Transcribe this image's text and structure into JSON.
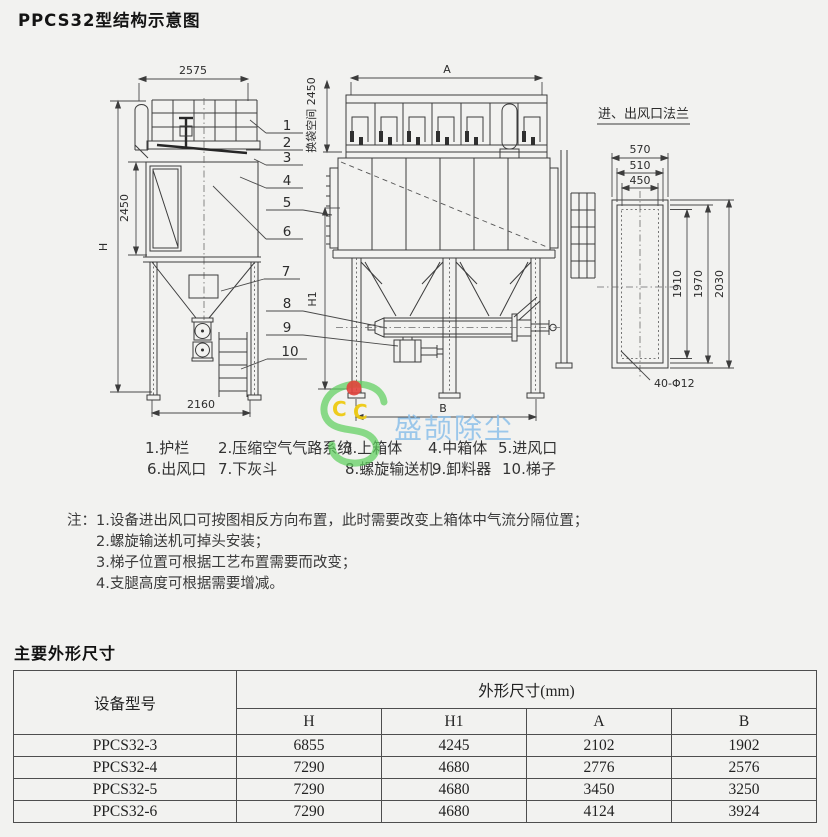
{
  "title": "PPCS32型结构示意图",
  "drawing": {
    "left_view": {
      "dim_width_top": "2575",
      "dim_height_mid": "2450",
      "dim_total_height": "H",
      "dim_width_bottom": "2160"
    },
    "front_view": {
      "dim_width_top": "A",
      "dim_bag_space": "换袋空间 2450",
      "dim_height_support": "H1",
      "dim_width_bottom": "B"
    },
    "flange_view": {
      "title": "进、出风口法兰",
      "dim_w1": "570",
      "dim_w2": "510",
      "dim_w3": "450",
      "dim_h1": "1910",
      "dim_h2": "1970",
      "dim_h3": "2030",
      "bolt_note": "40-Φ12"
    },
    "callouts": [
      "1",
      "2",
      "3",
      "4",
      "5",
      "6",
      "7",
      "8",
      "9",
      "10"
    ],
    "line_color": "#3c3c3c"
  },
  "legend": {
    "row1": [
      "1.护栏",
      "2.压缩空气气路系统",
      "3.上箱体",
      "4.中箱体",
      "5.进风口"
    ],
    "row2": [
      "6.出风口",
      "7.下灰斗",
      "8.螺旋输送机",
      "9.卸料器",
      "10.梯子"
    ]
  },
  "watermark": {
    "brand": "盛颉除尘",
    "letter_left": "C",
    "letter_right": "C",
    "brand_color": "#8cc0ea",
    "logo_green": "#5ecf5e",
    "letter_yellow": "#eecb12",
    "dot_red": "#e2423c"
  },
  "notes": {
    "label": "注：",
    "items": [
      "1.设备进出风口可按图相反方向布置，此时需要改变上箱体中气流分隔位置；",
      "2.螺旋输送机可掉头安装；",
      "3.梯子位置可根据工艺布置需要而改变；",
      "4.支腿高度可根据需要增减。"
    ]
  },
  "dimensions_section": {
    "title": "主要外形尺寸",
    "table": {
      "model_header": "设备型号",
      "dims_header": "外形尺寸(mm)",
      "columns": [
        "H",
        "H1",
        "A",
        "B"
      ],
      "rows": [
        {
          "model": "PPCS32-3",
          "values": [
            "6855",
            "4245",
            "2102",
            "1902"
          ]
        },
        {
          "model": "PPCS32-4",
          "values": [
            "7290",
            "4680",
            "2776",
            "2576"
          ]
        },
        {
          "model": "PPCS32-5",
          "values": [
            "7290",
            "4680",
            "3450",
            "3250"
          ]
        },
        {
          "model": "PPCS32-6",
          "values": [
            "7290",
            "4680",
            "4124",
            "3924"
          ]
        }
      ]
    }
  }
}
